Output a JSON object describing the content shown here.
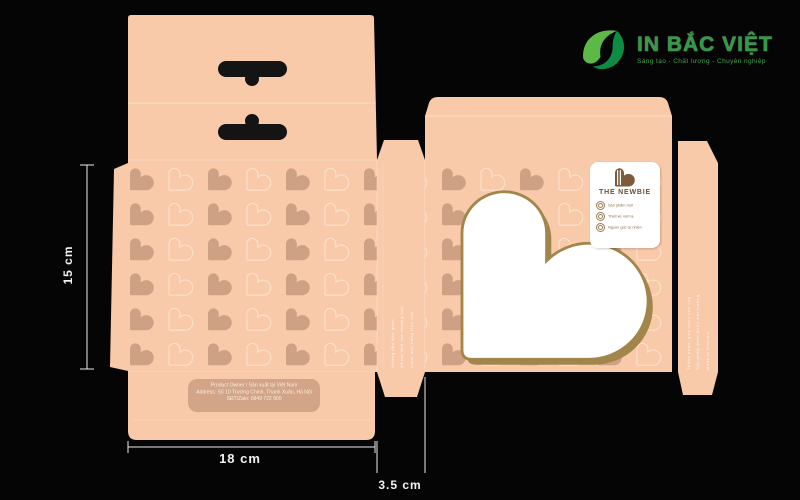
{
  "canvas": {
    "width": 800,
    "height": 500,
    "background": "#050505"
  },
  "brand_logo": {
    "name": "IN BẮC VIỆT",
    "tagline": "Sáng tạo - Chất lượng - Chuyên nghiệp",
    "icon": "leaf-swoosh-icon",
    "colors": {
      "light_green": "#5CB947",
      "dark_green": "#0E8B44",
      "text_green": "#2F9C45"
    }
  },
  "dimensions": {
    "height": "15 cm",
    "width": "18 cm",
    "depth": "3.5 cm"
  },
  "dieline": {
    "panel_color": "#F8CAAA",
    "pattern": {
      "solid_heart_color": "#CFA184",
      "outline_heart_color": "#F9E2CB"
    },
    "window": {
      "shape": "heart",
      "fill": "#FFFFFF",
      "outline": "#A1854B"
    },
    "label_card": {
      "brand": "THE NEWBIE",
      "features": [
        "Sản phẩm mới",
        "Thiết kế mới lạ",
        "Nguồn gốc tự nhiên"
      ]
    },
    "address_box": {
      "lines": [
        "Product Owner / Sản xuất tại Việt Nam",
        "Address: Số 10 Trường Chinh, Thanh Xuân, Hà Nội",
        "SĐT/Zalo: 0949 722 900"
      ]
    },
    "glue_panel_text": [
      "Hướng dẫn bảo quản",
      "để nơi khô ráo thoáng mát",
      "tránh ánh nắng trực tiếp"
    ],
    "side_panel_text": [
      "Thành phần: giấy ivory cao cấp",
      "Sản phẩm thân thiện môi trường",
      "Made in Vietnam"
    ]
  }
}
